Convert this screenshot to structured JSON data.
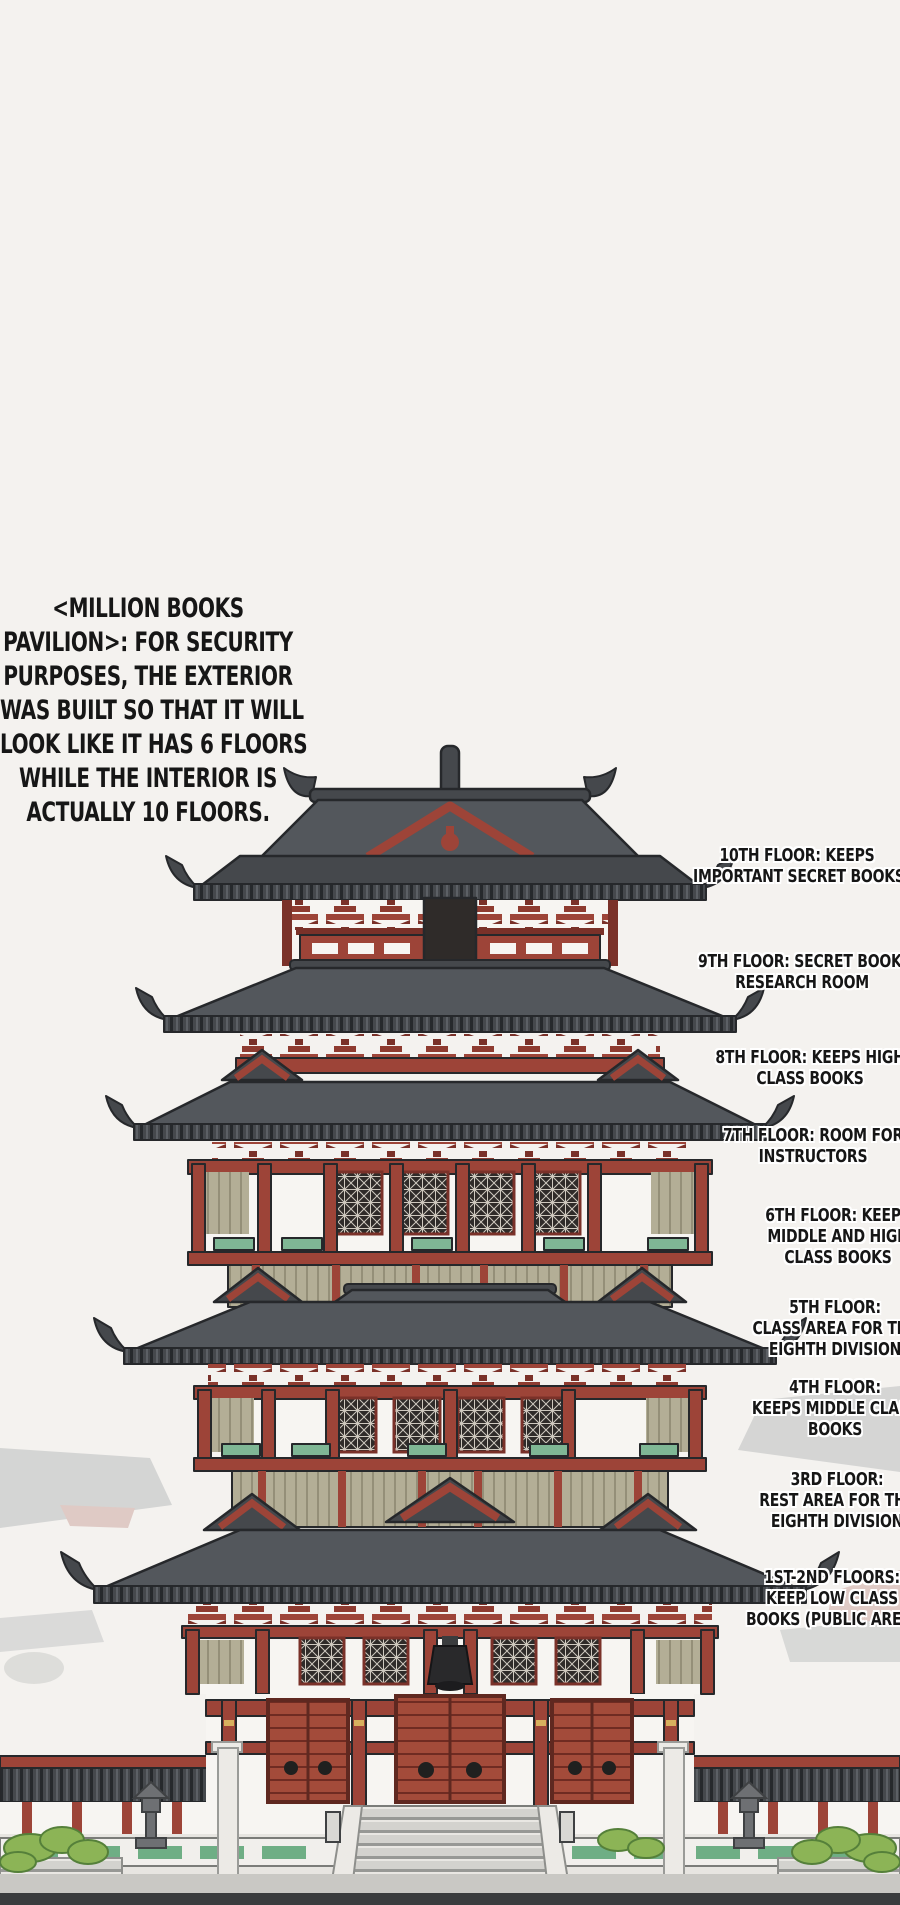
{
  "panel_type": "annotated pavilion illustration",
  "intro": {
    "text": "<MILLION BOOKS\nPAVILION>: FOR SECURITY\nPURPOSES, THE EXTERIOR\nWAS BUILT SO THAT IT WILL\nLOOK LIKE IT HAS 6 FLOORS\nWHILE THE INTERIOR IS\nACTUALLY 10 FLOORS."
  },
  "floors": [
    {
      "floor": "10th",
      "text": "10TH FLOOR: KEEPS\nIMPORTANT SECRET BOOKS"
    },
    {
      "floor": "9th",
      "text": "9TH FLOOR: SECRET BOOKS\nRESEARCH ROOM"
    },
    {
      "floor": "8th",
      "text": "8TH FLOOR: KEEPS HIGH\nCLASS BOOKS"
    },
    {
      "floor": "7th",
      "text": "7TH FLOOR: ROOM FOR\nINSTRUCTORS"
    },
    {
      "floor": "6th",
      "text": "6TH FLOOR: KEEPS\nMIDDLE AND HIGH\nCLASS BOOKS"
    },
    {
      "floor": "5th",
      "text": "5TH FLOOR:\nCLASS AREA FOR THE\nEIGHTH DIVISION"
    },
    {
      "floor": "4th",
      "text": "4TH FLOOR:\nKEEPS MIDDLE CLASS\nBOOKS"
    },
    {
      "floor": "3rd",
      "text": "3RD FLOOR:\nREST AREA FOR THE\nEIGHTH DIVISION"
    },
    {
      "floor": "1st-2nd",
      "text": "1ST-2ND FLOORS:\nKEEP LOW CLASS\nBOOKS (PUBLIC AREA)"
    }
  ],
  "palette": {
    "bg": "#f4f2ef",
    "ink": "#161616",
    "halo": "#ffffff",
    "roof_dark": "#45484c",
    "roof_mid": "#53575c",
    "outline": "#26282b",
    "red": "#9d4438",
    "red_dark": "#7a3129",
    "khaki": "#b3ae96",
    "green": "#7fb795",
    "stone_light": "#e7e5e1",
    "stone_dark": "#6e7073",
    "bush": "#8cb456"
  }
}
